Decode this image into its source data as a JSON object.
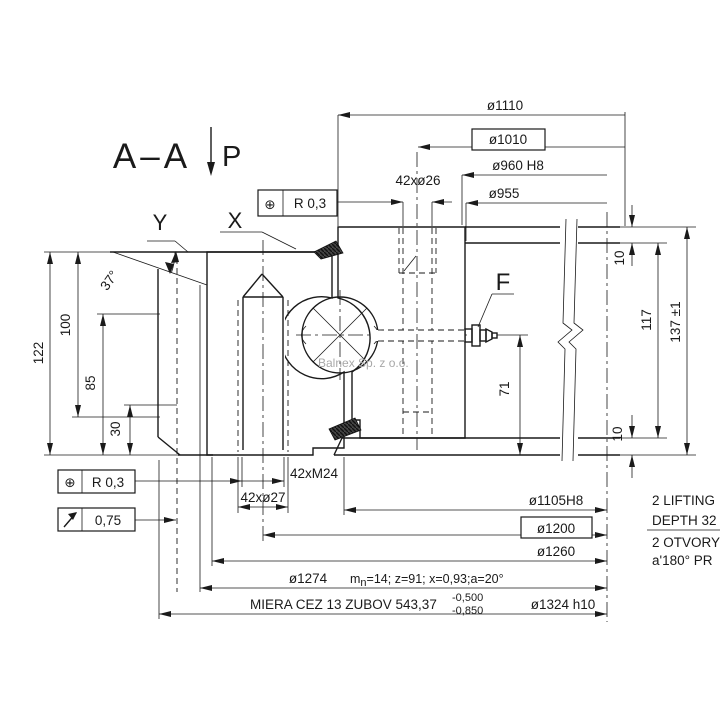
{
  "meta": {
    "background": "#ffffff",
    "ink": "#1a1a1a",
    "watermark_color": "#a8a8a8"
  },
  "header": {
    "section_label": "A–A",
    "view_direction": "P"
  },
  "detail_refs": {
    "y": "Y",
    "x": "X",
    "f": "F"
  },
  "tolerance_frames": {
    "top": {
      "symbol": "⊕",
      "value": "R 0,3"
    },
    "bottom": {
      "symbol": "⊕",
      "value": "R 0,3"
    },
    "runout": {
      "value": "0,75"
    }
  },
  "diameters_top": {
    "d1110": "ø1110",
    "d1010": "ø1010",
    "d960": "ø960 H8",
    "d955": "ø955"
  },
  "holes": {
    "outer": "42xø26",
    "thread": "42xM24",
    "through": "42xø27"
  },
  "heights": {
    "h122": "122",
    "h100": "100",
    "h85": "85",
    "h30": "30",
    "h117": "117",
    "h137": "137 ±1",
    "h71": "71",
    "h10_top": "10",
    "h10_bottom": "10"
  },
  "angle": {
    "tooth_chamfer": "37°"
  },
  "diameters_bottom": {
    "d1105": "ø1105H8",
    "d1200": "ø1200",
    "d1260": "ø1260",
    "d1274": "ø1274",
    "d1324": "ø1324 h10"
  },
  "gear": {
    "m_prefix": "m",
    "m_sub": "n",
    "params": "=14;  z=91;  x=0,93;a=20°",
    "measure_label": "MIERA CEZ 13 ZUBOV 543,37",
    "tol_upper": "-0,500",
    "tol_lower": "-0,850"
  },
  "notes": {
    "line1": "2 LIFTING",
    "line2": "DEPTH 32",
    "line3": "2 OTVORY",
    "line4": "a'180° PR"
  },
  "watermark": "Balnex Sp. z o.o."
}
